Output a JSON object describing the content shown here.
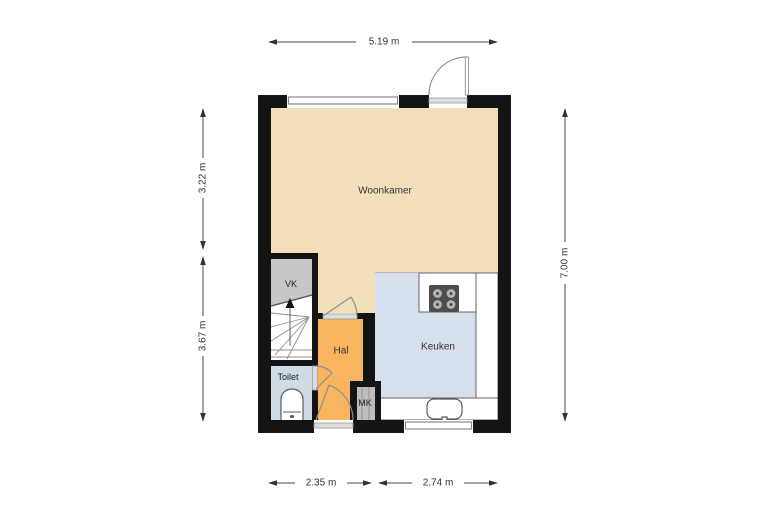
{
  "title": "floor-plan",
  "rooms": {
    "woonkamer": {
      "label": "Woonkamer",
      "color": "#F2DEB9"
    },
    "vk": {
      "label": "VK",
      "color": "#C7C7C7"
    },
    "hal": {
      "label": "Hal",
      "color": "#F6B55E"
    },
    "keuken": {
      "label": "Keuken",
      "color": "#D5E0EC"
    },
    "toilet": {
      "label": "Toilet",
      "color": "#CEDAE4"
    },
    "mk": {
      "label": "MK",
      "color": "#BDBDBD"
    }
  },
  "dimensions": {
    "top": "5.19 m",
    "left_upper": "3.22 m",
    "left_lower": "3.67 m",
    "right": "7.00 m",
    "bottom_left": "2.35 m",
    "bottom_right": "2.74 m"
  },
  "colors": {
    "wall": "#141414",
    "dimension_text": "#333333",
    "background": "#FFFFFF",
    "counter": "#FFFFFF",
    "stove": "#4D4D4D",
    "window_frame": "#8A8A8A"
  }
}
